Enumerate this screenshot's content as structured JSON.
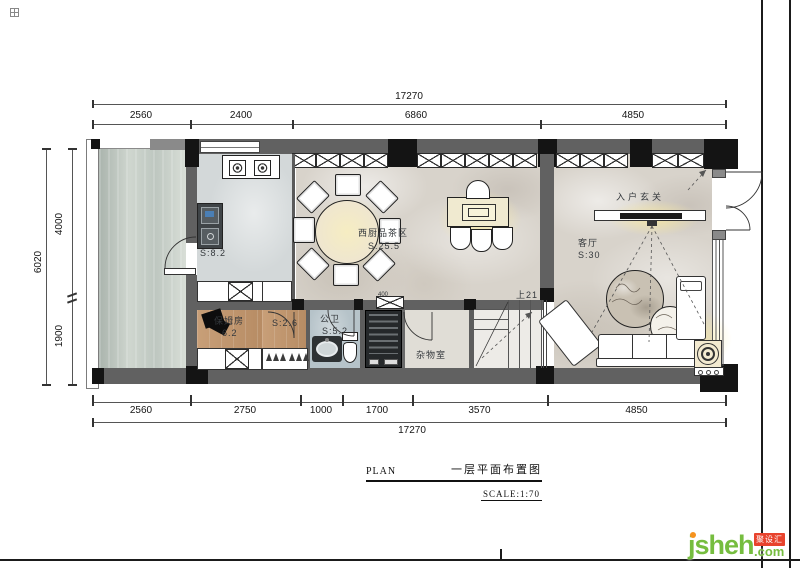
{
  "dims": {
    "top_total": "17270",
    "top": [
      "2560",
      "2400",
      "6860",
      "4850"
    ],
    "left_total": "6020",
    "left": [
      "4000",
      "1900"
    ],
    "bottom": [
      "2560",
      "2750",
      "1000",
      "1700",
      "3570",
      "4850"
    ],
    "bottom_total": "17270",
    "misc": "400"
  },
  "rooms": {
    "kitchen_area": "S:8.2",
    "tea_name": "西厨品茶区",
    "tea_area": "S:25.5",
    "entry_name": "入户玄关",
    "living_name": "客厅",
    "living_area": "S:30",
    "nanny_name": "保姆房",
    "nanny_area": "6.2",
    "closet_area": "S:2.6",
    "bath_name": "公卫",
    "bath_area": "S:5.2",
    "storage_name": "杂物室",
    "stairs_label": "上21"
  },
  "title_block": {
    "plan_label": "PLAN",
    "title": "一层平面布置图",
    "scale": "SCALE:1:70"
  },
  "watermark": {
    "brand": "jsheh",
    "suffix": ".com",
    "tag": "聚设汇"
  },
  "colors": {
    "wall": "#616161",
    "column": "#141414",
    "marble": "#d8d3cb",
    "wood": "#c49a72",
    "terrace": "#c3ccc4",
    "glow": "#f8e9a0",
    "brand_green": "#76bd3f",
    "brand_orange": "#f6921e",
    "brand_red": "#e8432d"
  }
}
